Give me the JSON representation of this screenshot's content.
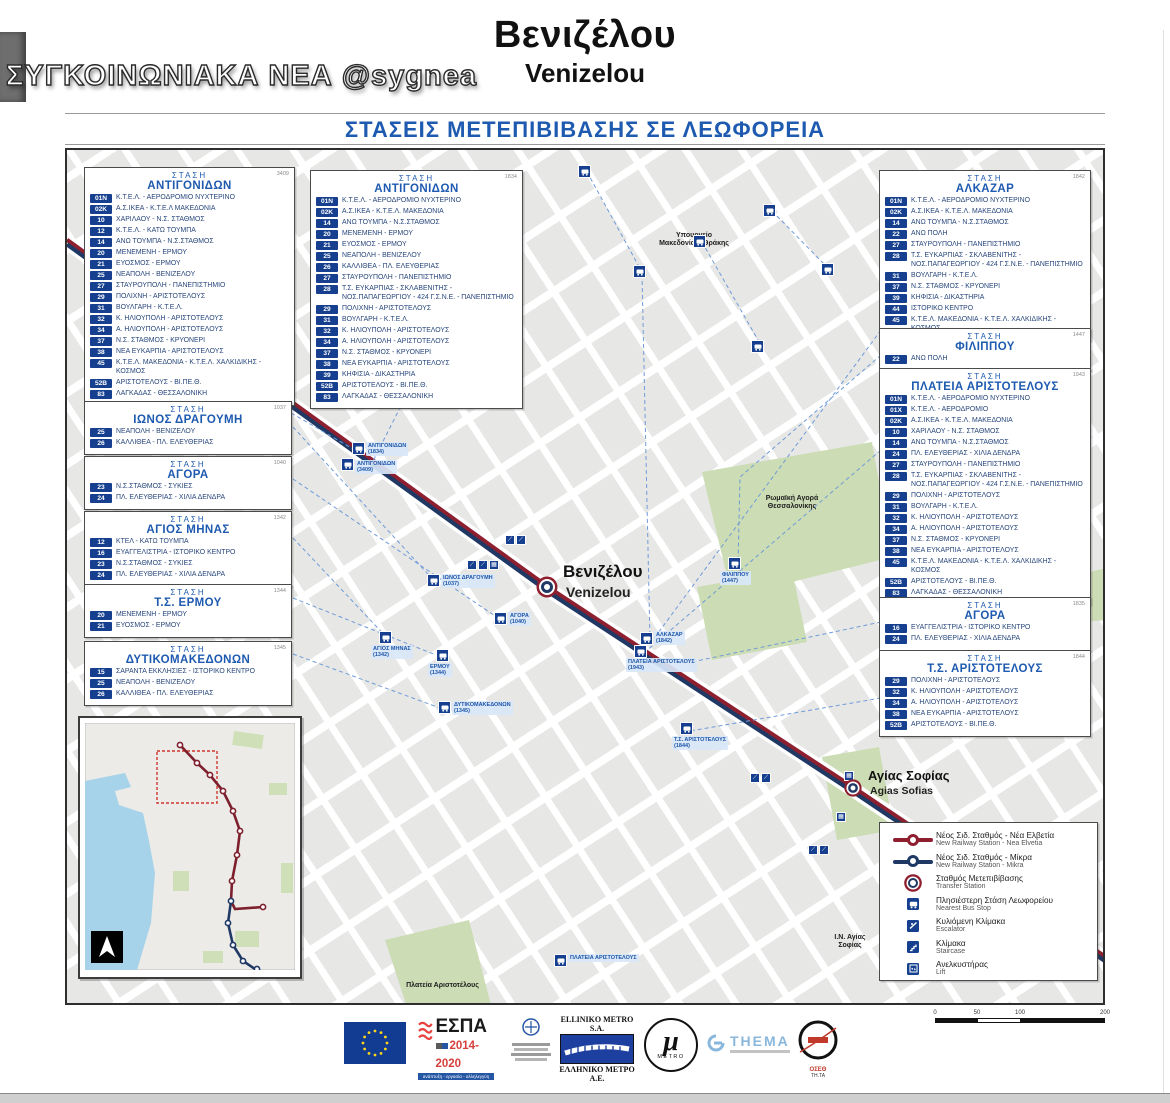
{
  "watermark": "ΣΥΓΚΟΙΝΩΝΙΑΚΑ ΝΕΑ @sygnea",
  "header": {
    "title_el": "Βενιζέλου",
    "title_en": "Venizelou",
    "subtitle": "ΣΤΑΣΕΙΣ ΜΕΤΕΠΙΒΙΒΑΣΗΣ ΣΕ ΛΕΩΦΟΡΕΙΑ"
  },
  "labels": {
    "stop_header": "ΣΤΑΣΗ"
  },
  "stations": [
    {
      "name": "ΑΝΤΙΓΟΝΙΔΩΝ",
      "code": "3409",
      "routes": [
        {
          "badge": "01N",
          "label": "Κ.Τ.Ε.Λ. - ΑΕΡΟΔΡΟΜΙΟ ΝΥΧΤΕΡΙΝΟ"
        },
        {
          "badge": "02K",
          "label": "Α.Σ.ΙΚΕΑ - Κ.Τ.Ε.Λ ΜΑΚΕΔΟΝΙΑ"
        },
        {
          "badge": "10",
          "label": "ΧΑΡΙΛΑΟΥ - Ν.Σ. ΣΤΑΘΜΟΣ"
        },
        {
          "badge": "12",
          "label": "Κ.Τ.Ε.Λ. - ΚΑΤΩ ΤΟΥΜΠΑ"
        },
        {
          "badge": "14",
          "label": "ΑΝΩ ΤΟΥΜΠΑ - Ν.Σ.ΣΤΑΘΜΟΣ"
        },
        {
          "badge": "20",
          "label": "ΜΕΝΕΜΕΝΗ - ΕΡΜΟΥ"
        },
        {
          "badge": "21",
          "label": "ΕΥΟΣΜΟΣ - ΕΡΜΟΥ"
        },
        {
          "badge": "25",
          "label": "ΝΕΑΠΟΛΗ - ΒΕΝΙΖΕΛΟΥ"
        },
        {
          "badge": "27",
          "label": "ΣΤΑΥΡΟΥΠΟΛΗ - ΠΑΝΕΠΙΣΤΗΜΙΟ"
        },
        {
          "badge": "29",
          "label": "ΠΟΛΙΧΝΗ - ΑΡΙΣΤΟΤΕΛΟΥΣ"
        },
        {
          "badge": "31",
          "label": "ΒΟΥΛΓΑΡΗ - Κ.Τ.Ε.Λ."
        },
        {
          "badge": "32",
          "label": "Κ. ΗΛΙΟΥΠΟΛΗ - ΑΡΙΣΤΟΤΕΛΟΥΣ"
        },
        {
          "badge": "34",
          "label": "Α. ΗΛΙΟΥΠΟΛΗ - ΑΡΙΣΤΟΤΕΛΟΥΣ"
        },
        {
          "badge": "37",
          "label": "Ν.Σ. ΣΤΑΘΜΟΣ - ΚΡΥΟΝΕΡΙ"
        },
        {
          "badge": "38",
          "label": "ΝΕΑ ΕΥΚΑΡΠΙΑ - ΑΡΙΣΤΟΤΕΛΟΥΣ"
        },
        {
          "badge": "45",
          "label": "Κ.Τ.Ε.Λ. ΜΑΚΕΔΟΝΙΑ - Κ.Τ.Ε.Λ. ΧΑΛΚΙΔΙΚΗΣ - ΚΟΣΜΟΣ"
        },
        {
          "badge": "52B",
          "label": "ΑΡΙΣΤΟΤΕΛΟΥΣ - ΒΙ.ΠΕ.Θ."
        },
        {
          "badge": "83",
          "label": "ΛΑΓΚΑΔΑΣ - ΘΕΣΣΑΛΟΝΙΚΗ"
        }
      ]
    },
    {
      "name": "ΑΝΤΙΓΟΝΙΔΩΝ",
      "code": "1834",
      "routes": [
        {
          "badge": "01N",
          "label": "Κ.Τ.Ε.Λ. - ΑΕΡΟΔΡΟΜΙΟ ΝΥΧΤΕΡΙΝΟ"
        },
        {
          "badge": "02K",
          "label": "Α.Σ.ΙΚΕΑ - Κ.Τ.Ε.Λ. ΜΑΚΕΔΟΝΙΑ"
        },
        {
          "badge": "14",
          "label": "ΑΝΩ ΤΟΥΜΠΑ - Ν.Σ.ΣΤΑΘΜΟΣ"
        },
        {
          "badge": "20",
          "label": "ΜΕΝΕΜΕΝΗ - ΕΡΜΟΥ"
        },
        {
          "badge": "21",
          "label": "ΕΥΟΣΜΟΣ - ΕΡΜΟΥ"
        },
        {
          "badge": "25",
          "label": "ΝΕΑΠΟΛΗ - ΒΕΝΙΖΕΛΟΥ"
        },
        {
          "badge": "26",
          "label": "ΚΑΛΛΙΘΕΑ - ΠΛ. ΕΛΕΥΘΕΡΙΑΣ"
        },
        {
          "badge": "27",
          "label": "ΣΤΑΥΡΟΥΠΟΛΗ - ΠΑΝΕΠΙΣΤΗΜΙΟ"
        },
        {
          "badge": "28",
          "label": "Τ.Σ. ΕΥΚΑΡΠΙΑΣ - ΣΚΛΑΒΕΝΙΤΗΣ - ΝΟΣ.ΠΑΠΑΓΕΩΡΓΙΟΥ - 424 Γ.Σ.Ν.Ε. - ΠΑΝΕΠΙΣΤΗΜΙΟ"
        },
        {
          "badge": "29",
          "label": "ΠΟΛΙΧΝΗ - ΑΡΙΣΤΟΤΕΛΟΥΣ"
        },
        {
          "badge": "31",
          "label": "ΒΟΥΛΓΑΡΗ - Κ.Τ.Ε.Λ."
        },
        {
          "badge": "32",
          "label": "Κ. ΗΛΙΟΥΠΟΛΗ - ΑΡΙΣΤΟΤΕΛΟΥΣ"
        },
        {
          "badge": "34",
          "label": "Α. ΗΛΙΟΥΠΟΛΗ - ΑΡΙΣΤΟΤΕΛΟΥΣ"
        },
        {
          "badge": "37",
          "label": "Ν.Σ. ΣΤΑΘΜΟΣ - ΚΡΥΟΝΕΡΙ"
        },
        {
          "badge": "38",
          "label": "ΝΕΑ ΕΥΚΑΡΠΙΑ - ΑΡΙΣΤΟΤΕΛΟΥΣ"
        },
        {
          "badge": "39",
          "label": "ΚΗΦΙΣΙΑ - ΔΙΚΑΣΤΗΡΙΑ"
        },
        {
          "badge": "52B",
          "label": "ΑΡΙΣΤΟΤΕΛΟΥΣ - ΒΙ.ΠΕ.Θ."
        },
        {
          "badge": "83",
          "label": "ΛΑΓΚΑΔΑΣ - ΘΕΣΣΑΛΟΝΙΚΗ"
        }
      ]
    },
    {
      "name": "ΑΛΚΑΖΑΡ",
      "code": "1842",
      "routes": [
        {
          "badge": "01N",
          "label": "Κ.Τ.Ε.Λ. - ΑΕΡΟΔΡΟΜΙΟ ΝΥΧΤΕΡΙΝΟ"
        },
        {
          "badge": "02K",
          "label": "Α.Σ.ΙΚΕΑ - Κ.Τ.Ε.Λ. ΜΑΚΕΔΟΝΙΑ"
        },
        {
          "badge": "14",
          "label": "ΑΝΩ ΤΟΥΜΠΑ - Ν.Σ.ΣΤΑΘΜΟΣ"
        },
        {
          "badge": "22",
          "label": "ΑΝΩ ΠΟΛΗ"
        },
        {
          "badge": "27",
          "label": "ΣΤΑΥΡΟΥΠΟΛΗ - ΠΑΝΕΠΙΣΤΗΜΙΟ"
        },
        {
          "badge": "28",
          "label": "Τ.Σ. ΕΥΚΑΡΠΙΑΣ - ΣΚΛΑΒΕΝΙΤΗΣ - ΝΟΣ.ΠΑΠΑΓΕΩΡΓΙΟΥ - 424 Γ.Σ.Ν.Ε. - ΠΑΝΕΠΙΣΤΗΜΙΟ"
        },
        {
          "badge": "31",
          "label": "ΒΟΥΛΓΑΡΗ - Κ.Τ.Ε.Λ."
        },
        {
          "badge": "37",
          "label": "Ν.Σ. ΣΤΑΘΜΟΣ - ΚΡΥΟΝΕΡΙ"
        },
        {
          "badge": "39",
          "label": "ΚΗΦΙΣΙΑ - ΔΙΚΑΣΤΗΡΙΑ"
        },
        {
          "badge": "44",
          "label": "ΙΣΤΟΡΙΚΟ ΚΕΝΤΡΟ"
        },
        {
          "badge": "45",
          "label": "Κ.Τ.Ε.Λ. ΜΑΚΕΔΟΝΙΑ - Κ.Τ.Ε.Λ. ΧΑΛΚΙΔΙΚΗΣ - ΚΟΣΜΟΣ"
        }
      ]
    },
    {
      "name": "ΦΙΛΙΠΠΟΥ",
      "code": "1447",
      "routes": [
        {
          "badge": "22",
          "label": "ΑΝΩ ΠΟΛΗ"
        }
      ]
    },
    {
      "name": "ΠΛΑΤΕΙΑ ΑΡΙΣΤΟΤΕΛΟΥΣ",
      "code": "1943",
      "routes": [
        {
          "badge": "01N",
          "label": "Κ.Τ.Ε.Λ. - ΑΕΡΟΔΡΟΜΙΟ ΝΥΧΤΕΡΙΝΟ"
        },
        {
          "badge": "01X",
          "label": "Κ.Τ.Ε.Λ. - ΑΕΡΟΔΡΟΜΙΟ"
        },
        {
          "badge": "02K",
          "label": "Α.Σ.ΙΚΕΑ - Κ.Τ.Ε.Λ. ΜΑΚΕΔΟΝΙΑ"
        },
        {
          "badge": "10",
          "label": "ΧΑΡΙΛΑΟΥ - Ν.Σ. ΣΤΑΘΜΟΣ"
        },
        {
          "badge": "14",
          "label": "ΑΝΩ ΤΟΥΜΠΑ - Ν.Σ.ΣΤΑΘΜΟΣ"
        },
        {
          "badge": "24",
          "label": "ΠΛ. ΕΛΕΥΘΕΡΙΑΣ - ΧΙΛΙΑ ΔΕΝΔΡΑ"
        },
        {
          "badge": "27",
          "label": "ΣΤΑΥΡΟΥΠΟΛΗ - ΠΑΝΕΠΙΣΤΗΜΙΟ"
        },
        {
          "badge": "28",
          "label": "Τ.Σ. ΕΥΚΑΡΠΙΑΣ - ΣΚΛΑΒΕΝΙΤΗΣ - ΝΟΣ.ΠΑΠΑΓΕΩΡΓΙΟΥ - 424 Γ.Σ.Ν.Ε. - ΠΑΝΕΠΙΣΤΗΜΙΟ"
        },
        {
          "badge": "29",
          "label": "ΠΟΛΙΧΝΗ - ΑΡΙΣΤΟΤΕΛΟΥΣ"
        },
        {
          "badge": "31",
          "label": "ΒΟΥΛΓΑΡΗ - Κ.Τ.Ε.Λ."
        },
        {
          "badge": "32",
          "label": "Κ. ΗΛΙΟΥΠΟΛΗ - ΑΡΙΣΤΟΤΕΛΟΥΣ"
        },
        {
          "badge": "34",
          "label": "Α. ΗΛΙΟΥΠΟΛΗ - ΑΡΙΣΤΟΤΕΛΟΥΣ"
        },
        {
          "badge": "37",
          "label": "Ν.Σ. ΣΤΑΘΜΟΣ - ΚΡΥΟΝΕΡΙ"
        },
        {
          "badge": "38",
          "label": "ΝΕΑ ΕΥΚΑΡΠΙΑ - ΑΡΙΣΤΟΤΕΛΟΥΣ"
        },
        {
          "badge": "45",
          "label": "Κ.Τ.Ε.Λ. ΜΑΚΕΔΟΝΙΑ - Κ.Τ.Ε.Λ. ΧΑΛΚΙΔΙΚΗΣ - ΚΟΣΜΟΣ"
        },
        {
          "badge": "52B",
          "label": "ΑΡΙΣΤΟΤΕΛΟΥΣ - ΒΙ.ΠΕ.Θ."
        },
        {
          "badge": "83",
          "label": "ΛΑΓΚΑΔΑΣ - ΘΕΣΣΑΛΟΝΙΚΗ"
        }
      ]
    },
    {
      "name": "ΑΓΟΡΑ",
      "code": "1835",
      "routes": [
        {
          "badge": "16",
          "label": "ΕΥΑΓΓΕΛΙΣΤΡΙΑ - ΙΣΤΟΡΙΚΟ ΚΕΝΤΡΟ"
        },
        {
          "badge": "24",
          "label": "ΠΛ. ΕΛΕΥΘΕΡΙΑΣ - ΧΙΛΙΑ ΔΕΝΔΡΑ"
        }
      ]
    },
    {
      "name": "Τ.Σ. ΑΡΙΣΤΟΤΕΛΟΥΣ",
      "code": "1844",
      "routes": [
        {
          "badge": "29",
          "label": "ΠΟΛΙΧΝΗ - ΑΡΙΣΤΟΤΕΛΟΥΣ"
        },
        {
          "badge": "32",
          "label": "Κ. ΗΛΙΟΥΠΟΛΗ - ΑΡΙΣΤΟΤΕΛΟΥΣ"
        },
        {
          "badge": "34",
          "label": "Α. ΗΛΙΟΥΠΟΛΗ - ΑΡΙΣΤΟΤΕΛΟΥΣ"
        },
        {
          "badge": "38",
          "label": "ΝΕΑ ΕΥΚΑΡΠΙΑ - ΑΡΙΣΤΟΤΕΛΟΥΣ"
        },
        {
          "badge": "52B",
          "label": "ΑΡΙΣΤΟΤΕΛΟΥΣ - ΒΙ.ΠΕ.Θ."
        }
      ]
    },
    {
      "name": "ΙΩΝΟΣ ΔΡΑΓΟΥΜΗ",
      "code": "1037",
      "routes": [
        {
          "badge": "25",
          "label": "ΝΕΑΠΟΛΗ - ΒΕΝΙΖΕΛΟΥ"
        },
        {
          "badge": "26",
          "label": "ΚΑΛΛΙΘΕΑ - ΠΛ. ΕΛΕΥΘΕΡΙΑΣ"
        }
      ]
    },
    {
      "name": "ΑΓΟΡΑ",
      "code": "1040",
      "routes": [
        {
          "badge": "23",
          "label": "Ν.Σ.ΣΤΑΘΜΟΣ - ΣΥΚΙΕΣ"
        },
        {
          "badge": "24",
          "label": "ΠΛ. ΕΛΕΥΘΕΡΙΑΣ - ΧΙΛΙΑ ΔΕΝΔΡΑ"
        }
      ]
    },
    {
      "name": "ΑΓΙΟΣ ΜΗΝΑΣ",
      "code": "1342",
      "routes": [
        {
          "badge": "12",
          "label": "ΚΤΕΛ - ΚΑΤΩ ΤΟΥΜΠΑ"
        },
        {
          "badge": "16",
          "label": "ΕΥΑΓΓΕΛΙΣΤΡΙΑ - ΙΣΤΟΡΙΚΟ ΚΕΝΤΡΟ"
        },
        {
          "badge": "23",
          "label": "Ν.Σ.ΣΤΑΘΜΟΣ - ΣΥΚΙΕΣ"
        },
        {
          "badge": "24",
          "label": "ΠΛ. ΕΛΕΥΘΕΡΙΑΣ - ΧΙΛΙΑ ΔΕΝΔΡΑ"
        }
      ]
    },
    {
      "name": "Τ.Σ. ΕΡΜΟΥ",
      "code": "1344",
      "routes": [
        {
          "badge": "20",
          "label": "ΜΕΝΕΜΕΝΗ - ΕΡΜΟΥ"
        },
        {
          "badge": "21",
          "label": "ΕΥΟΣΜΟΣ - ΕΡΜΟΥ"
        }
      ]
    },
    {
      "name": "ΔΥΤΙΚΟΜΑΚΕΔΟΝΩΝ",
      "code": "1345",
      "routes": [
        {
          "badge": "15",
          "label": "ΣΑΡΑΝΤΑ ΕΚΚΛΗΣΙΕΣ - ΙΣΤΟΡΙΚΟ ΚΕΝΤΡΟ"
        },
        {
          "badge": "25",
          "label": "ΝΕΑΠΟΛΗ - ΒΕΝΙΖΕΛΟΥ"
        },
        {
          "badge": "26",
          "label": "ΚΑΛΛΙΘΕΑ - ΠΛ. ΕΛΕΥΘΕΡΙΑΣ"
        }
      ]
    }
  ],
  "map": {
    "station_markers": [
      {
        "name_el": "Βενιζέλου",
        "name_en": "Venizelou"
      },
      {
        "name_el": "Αγίας Σοφίας",
        "name_en": "Agias Sofias"
      }
    ],
    "labels": [
      {
        "text": "Υπουργείο Μακεδονίας- Θράκης"
      },
      {
        "text": "Ρωμαϊκή Αγορά Θεσσαλονίκης"
      },
      {
        "text": "Πλατεία Αριστοτέλους"
      },
      {
        "text": "Ι.Ν. Αγίας Σοφίας"
      }
    ],
    "stops": [
      {
        "name": "ΑΝΤΙΓΟΝΙΔΩΝ",
        "code": "(1834)"
      },
      {
        "name": "ΑΝΤΙΓΟΝΙΔΩΝ",
        "code": "(3409)"
      },
      {
        "name": "ΙΩΝΟΣ ΔΡΑΓΟΥΜΗ",
        "code": "(1037)"
      },
      {
        "name": "ΑΓΙΟΣ ΜΗΝΑΣ",
        "code": "(1342)"
      },
      {
        "name": "ΕΡΜΟΥ",
        "code": "(1344)"
      },
      {
        "name": "ΔΥΤΙΚΟΜΑΚΕΔΟΝΩΝ",
        "code": "(1345)"
      },
      {
        "name": "ΑΓΟΡΑ",
        "code": "(1040)"
      },
      {
        "name": "ΑΛΚΑΖΑΡ",
        "code": "(1842)"
      },
      {
        "name": "ΠΛΑΤΕΙΑ ΑΡΙΣΤΟΤΕΛΟΥΣ",
        "code": "(1943)"
      },
      {
        "name": "Τ.Σ. ΑΡΙΣΤΟΤΕΛΟΥΣ",
        "code": "(1844)"
      },
      {
        "name": "ΦΙΛΙΠΠΟΥ",
        "code": "(1447)"
      },
      {
        "name": "ΠΛΑΤΕΙΑ ΑΡΙΣΤΟΤΕΛΟΥΣ",
        "code": ""
      }
    ]
  },
  "legend": {
    "items": [
      {
        "el": "Νέος Σιδ. Σταθμός - Νέα Ελβετία",
        "en": "New Railway Station - Nea Elvetia"
      },
      {
        "el": "Νέος Σιδ. Σταθμός - Μίκρα",
        "en": "New Railway Station - Mikra"
      },
      {
        "el": "Σταθμός Μετεπιβίβασης",
        "en": "Transfer Station"
      },
      {
        "el": "Πλησιέστερη Στάση Λεωφορείου",
        "en": "Nearest Bus Stop"
      },
      {
        "el": "Κυλιόμενη Κλίμακα",
        "en": "Escalator"
      },
      {
        "el": "Κλίμακα",
        "en": "Staircase"
      },
      {
        "el": "Ανελκυστήρας",
        "en": "Lift"
      }
    ]
  },
  "scalebar": {
    "ticks": [
      "0",
      "50",
      "100",
      "200"
    ]
  },
  "footer": {
    "espa_name": "ΕΣΠΑ",
    "espa_years": "2014-2020",
    "espa_tagline": "ανάπτυξη - εργασία - αλληλεγγύη",
    "metro_en": "ELLINIKO METRO S.A.",
    "metro_el": "ΕΛΛΗΝΙΚΟ ΜΕΤΡΟ Α.Ε.",
    "metro_mu": "μ",
    "metro_word": "METRO",
    "thema": "THEMA",
    "oseth": "ΟΣΕΘ",
    "oseth_sub": "ΤΗ.ΤΑ"
  },
  "colors": {
    "line_red": "#8e1f2f",
    "line_blue": "#1f3864",
    "badge_blue": "#16408f",
    "heading_blue": "#1e5ab0"
  }
}
